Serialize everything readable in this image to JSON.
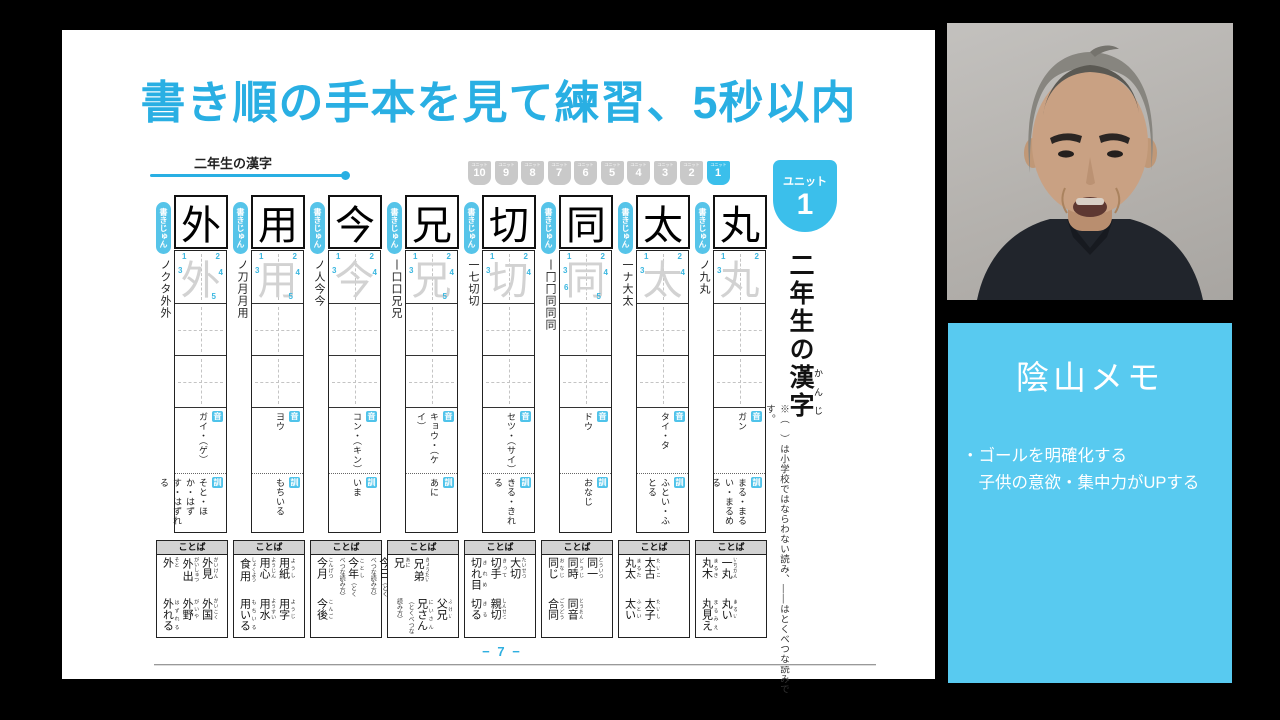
{
  "slide": {
    "title": "書き順の手本を見て練習、5秒以内",
    "section_label": "二年生の漢字",
    "unit_label": "ユニット",
    "unit_numbers": [
      "10",
      "9",
      "8",
      "7",
      "6",
      "5",
      "4",
      "3",
      "2",
      "1"
    ],
    "active_unit": "1",
    "big_badge": {
      "label": "ユニット",
      "number": "1"
    },
    "vertical_title_prefix": "二年生の",
    "vertical_title_kanji": "漢字",
    "vertical_title_furigana": "かんじ",
    "side_note": "※（　）は小学校ではならわない読み、――はとくべつな読みです。",
    "stroke_tab": "書きじゅん",
    "on_label": "音",
    "kun_label": "訓",
    "words_label": "ことば",
    "page_number": "− 7 −"
  },
  "kanji_columns": [
    {
      "kanji": "外",
      "strokes": "ノクタ外外",
      "stroke_numbers": [
        "1",
        "2",
        "3",
        "4",
        "5"
      ],
      "on": "ガイ・（ゲ）",
      "kun": "そと・ほか・はずす・はずれる",
      "words_top": [
        {
          "w": "外見",
          "r": "がいけん"
        },
        {
          "w": "外出",
          "r": "がいしゅつ"
        },
        {
          "w": "外",
          "r": "そと"
        }
      ],
      "words_bottom": [
        {
          "w": "外国",
          "r": "がいこく"
        },
        {
          "w": "外野",
          "r": "がいや"
        },
        {
          "w": "外れる",
          "r": "はずれる"
        }
      ]
    },
    {
      "kanji": "用",
      "strokes": "ノ刀月月用",
      "stroke_numbers": [
        "1",
        "2",
        "3",
        "4",
        "5"
      ],
      "on": "ヨウ",
      "kun": "もちいる",
      "words_top": [
        {
          "w": "用紙",
          "r": "ようし"
        },
        {
          "w": "用心",
          "r": "ようじん"
        },
        {
          "w": "食用",
          "r": "しょくよう"
        }
      ],
      "words_bottom": [
        {
          "w": "用字",
          "r": "ようじ"
        },
        {
          "w": "用水",
          "r": "ようすい"
        },
        {
          "w": "用いる",
          "r": "もちいる"
        }
      ]
    },
    {
      "kanji": "今",
      "strokes": "ノ人今今",
      "stroke_numbers": [
        "1",
        "2",
        "3",
        "4"
      ],
      "on": "コン・（キン）",
      "kun": "いま",
      "words_top": [
        {
          "w": "今日",
          "r": "きょう",
          "note": "（とくべつな読み方）"
        },
        {
          "w": "今年",
          "r": "ことし",
          "note": "（とくべつな読み方）"
        },
        {
          "w": "今月",
          "r": "こんげつ"
        }
      ],
      "words_bottom": [
        {
          "w": "今後",
          "r": "こんご"
        }
      ]
    },
    {
      "kanji": "兄",
      "strokes": "丨口口兄兄",
      "stroke_numbers": [
        "1",
        "2",
        "3",
        "4",
        "5"
      ],
      "on": "キョウ・（ケイ）",
      "kun": "あに",
      "words_top": [
        {
          "w": "兄弟",
          "r": "きょうだい"
        },
        {
          "w": "兄",
          "r": "あに"
        }
      ],
      "words_bottom": [
        {
          "w": "父兄",
          "r": "ふけい"
        },
        {
          "w": "兄さん",
          "r": "にいさん",
          "note": "（とくべつな読み方）"
        }
      ]
    },
    {
      "kanji": "切",
      "strokes": "一七切切",
      "stroke_numbers": [
        "1",
        "2",
        "3",
        "4"
      ],
      "on": "セツ・（サイ）",
      "kun": "きる・きれる",
      "words_top": [
        {
          "w": "大切",
          "r": "たいせつ"
        },
        {
          "w": "切手",
          "r": "きって"
        },
        {
          "w": "切れ目",
          "r": "きれめ"
        }
      ],
      "words_bottom": [
        {
          "w": "親切",
          "r": "しんせつ"
        },
        {
          "w": "切る",
          "r": "きる"
        }
      ]
    },
    {
      "kanji": "同",
      "strokes": "丨冂冂同同同",
      "stroke_numbers": [
        "1",
        "2",
        "3",
        "4",
        "5",
        "6"
      ],
      "on": "ドウ",
      "kun": "おなじ",
      "words_top": [
        {
          "w": "同一",
          "r": "どういつ"
        },
        {
          "w": "同時",
          "r": "どうじ"
        },
        {
          "w": "同じ",
          "r": "おなじ"
        }
      ],
      "words_bottom": [
        {
          "w": "同音",
          "r": "どうおん"
        },
        {
          "w": "合同",
          "r": "ごうどう"
        }
      ]
    },
    {
      "kanji": "太",
      "strokes": "一ナ大太",
      "stroke_numbers": [
        "1",
        "2",
        "3",
        "4"
      ],
      "on": "タイ・タ",
      "kun": "ふとい・ふとる",
      "words_top": [
        {
          "w": "太古",
          "r": "たいこ"
        },
        {
          "w": "丸太",
          "r": "まるた"
        }
      ],
      "words_bottom": [
        {
          "w": "太子",
          "r": "たいし"
        },
        {
          "w": "太い",
          "r": "ふとい"
        }
      ]
    },
    {
      "kanji": "丸",
      "strokes": "ノ九丸",
      "stroke_numbers": [
        "1",
        "2",
        "3"
      ],
      "on": "ガン",
      "kun": "まる・まるい・まるめる",
      "words_top": [
        {
          "w": "一丸",
          "r": "いちがん"
        },
        {
          "w": "丸木",
          "r": "まるき"
        }
      ],
      "words_bottom": [
        {
          "w": "丸い",
          "r": "まるい"
        },
        {
          "w": "丸見え",
          "r": "まるみえ"
        }
      ]
    }
  ],
  "memo": {
    "title": "陰山メモ",
    "lines": [
      "・ゴールを明確化する",
      "　子供の意欲・集中力がUPする"
    ]
  }
}
